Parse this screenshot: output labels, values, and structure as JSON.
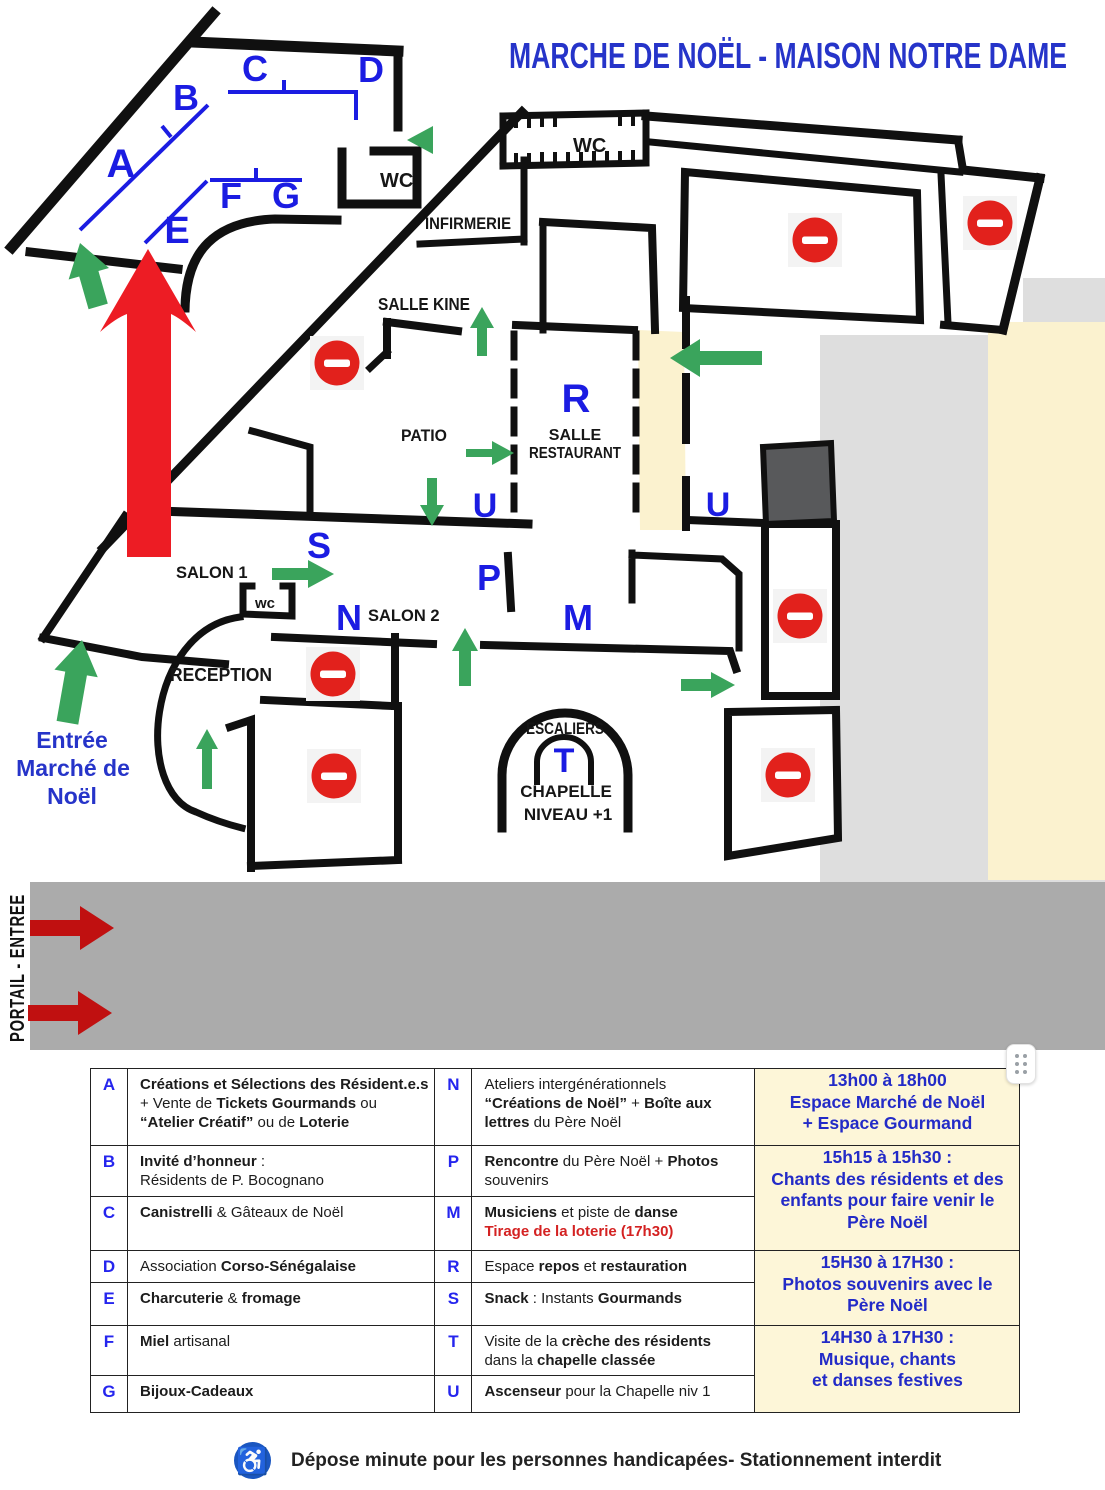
{
  "title": "MARCHE DE NOËL - MAISON NOTRE DAME",
  "colors": {
    "blue": "#2634c9",
    "letter_blue": "#1b1ce2",
    "green": "#3aa45c",
    "no_entry_red": "#e2211c",
    "arrow_red": "#ed1c24",
    "portal_arrow_red": "#c01010",
    "corridor_yellow": "#fbf2cf",
    "schedule_yellow": "#fdf6d8",
    "gray_light": "#dedede",
    "gray_band": "#ababab",
    "elevator_dark": "#58595b",
    "red_text": "#d42222"
  },
  "map": {
    "markers": {
      "a": "A",
      "b": "B",
      "c": "C",
      "d": "D",
      "e": "E",
      "f": "F",
      "g": "G",
      "n": "N",
      "p": "P",
      "m": "M",
      "r": "R",
      "s": "S",
      "t": "T",
      "u": "U"
    },
    "labels": {
      "wc_market": "WC",
      "wc_main": "WC",
      "wc_small": "wc",
      "infirmerie": "INFIRMERIE",
      "salle_kine": "SALLE KINE",
      "patio": "PATIO",
      "salle": "SALLE",
      "restaurant": "RESTAURANT",
      "salon1": "SALON 1",
      "salon2": "SALON 2",
      "reception": "RECEPTION",
      "escaliers": "ESCALIERS",
      "chapelle": "CHAPELLE",
      "niveau": "NIVEAU +1",
      "entree1": "Entrée",
      "entree2": "Marché de",
      "entree3": "Noël",
      "portail": "PORTAIL - ENTREE"
    }
  },
  "legend": {
    "rows": [
      {
        "l1": "A",
        "d1": [
          [
            {
              "t": "Créations et Sélections des Résident.e.s",
              "b": 1
            }
          ],
          [
            {
              "t": "+ Vente de "
            },
            {
              "t": "Tickets Gourmands",
              "b": 1
            },
            {
              "t": " ou"
            }
          ],
          [
            {
              "t": "“Atelier Créatif”",
              "b": 1
            },
            {
              "t": " ou de "
            },
            {
              "t": "Loterie",
              "b": 1
            }
          ]
        ],
        "l2": "N",
        "d2": [
          [
            {
              "t": "Ateliers intergénérationnels"
            }
          ],
          [
            {
              "t": "“Créations de Noël”",
              "b": 1
            },
            {
              "t": " + "
            },
            {
              "t": "Boîte aux",
              "b": 1
            }
          ],
          [
            {
              "t": "lettres",
              "b": 1
            },
            {
              "t": " du Père Noël"
            }
          ]
        ]
      },
      {
        "l1": "B",
        "d1": [
          [
            {
              "t": "Invité d’honneur",
              "b": 1
            },
            {
              "t": " :"
            }
          ],
          [
            {
              "t": "Résidents de P. Bocognano"
            }
          ]
        ],
        "l2": "P",
        "d2": [
          [
            {
              "t": "Rencontre",
              "b": 1
            },
            {
              "t": " du Père Noël + "
            },
            {
              "t": "Photos",
              "b": 1
            }
          ],
          [
            {
              "t": "souvenirs"
            }
          ]
        ]
      },
      {
        "l1": "C",
        "d1": [
          [
            {
              "t": "Canistrelli",
              "b": 1
            },
            {
              "t": " & Gâteaux de Noël"
            }
          ]
        ],
        "l2": "M",
        "d2": [
          [
            {
              "t": "Musiciens",
              "b": 1
            },
            {
              "t": " et piste de "
            },
            {
              "t": "danse",
              "b": 1
            }
          ],
          [
            {
              "t": "Tirage de la loterie (17h30)",
              "b": 1,
              "r": 1
            }
          ]
        ]
      },
      {
        "l1": "D",
        "d1": [
          [
            {
              "t": "Association "
            },
            {
              "t": "Corso-Sénégalaise",
              "b": 1
            }
          ]
        ],
        "l2": "R",
        "d2": [
          [
            {
              "t": "Espace "
            },
            {
              "t": "repos",
              "b": 1
            },
            {
              "t": " et "
            },
            {
              "t": "restauration",
              "b": 1
            }
          ]
        ]
      },
      {
        "l1": "E",
        "d1": [
          [
            {
              "t": "Charcuterie",
              "b": 1
            },
            {
              "t": " & "
            },
            {
              "t": "fromage",
              "b": 1
            }
          ]
        ],
        "l2": "S",
        "d2": [
          [
            {
              "t": "Snack",
              "b": 1
            },
            {
              "t": " : Instants "
            },
            {
              "t": "Gourmands",
              "b": 1
            }
          ]
        ]
      },
      {
        "l1": "F",
        "d1": [
          [
            {
              "t": "Miel",
              "b": 1
            },
            {
              "t": " artisanal"
            }
          ]
        ],
        "l2": "T",
        "d2": [
          [
            {
              "t": "Visite de la "
            },
            {
              "t": "crèche des résidents",
              "b": 1
            }
          ],
          [
            {
              "t": "dans la "
            },
            {
              "t": "chapelle classée",
              "b": 1
            }
          ]
        ]
      },
      {
        "l1": "G",
        "d1": [
          [
            {
              "t": "Bijoux-Cadeaux",
              "b": 1
            }
          ]
        ],
        "l2": "U",
        "d2": [
          [
            {
              "t": "Ascenseur",
              "b": 1
            },
            {
              "t": " pour la Chapelle niv 1"
            }
          ]
        ]
      }
    ],
    "schedule": [
      {
        "span": 1,
        "lines": [
          "13h00 à 18h00",
          "Espace Marché de Noël",
          "+ Espace Gourmand"
        ]
      },
      {
        "span": 2,
        "lines": [
          "15h15 à 15h30 :",
          "Chants des résidents et des",
          "enfants pour faire venir le",
          "Père Noël"
        ]
      },
      {
        "span": 2,
        "lines": [
          "15H30 à 17H30 :",
          "Photos souvenirs avec le",
          "Père Noël"
        ]
      },
      {
        "span": 2,
        "lines": [
          "14H30 à 17H30 :",
          "Musique, chants",
          "et danses festives"
        ]
      }
    ]
  },
  "footer": {
    "icon": "♿",
    "note": "Dépose minute pour les personnes handicapées- Stationnement interdit"
  }
}
